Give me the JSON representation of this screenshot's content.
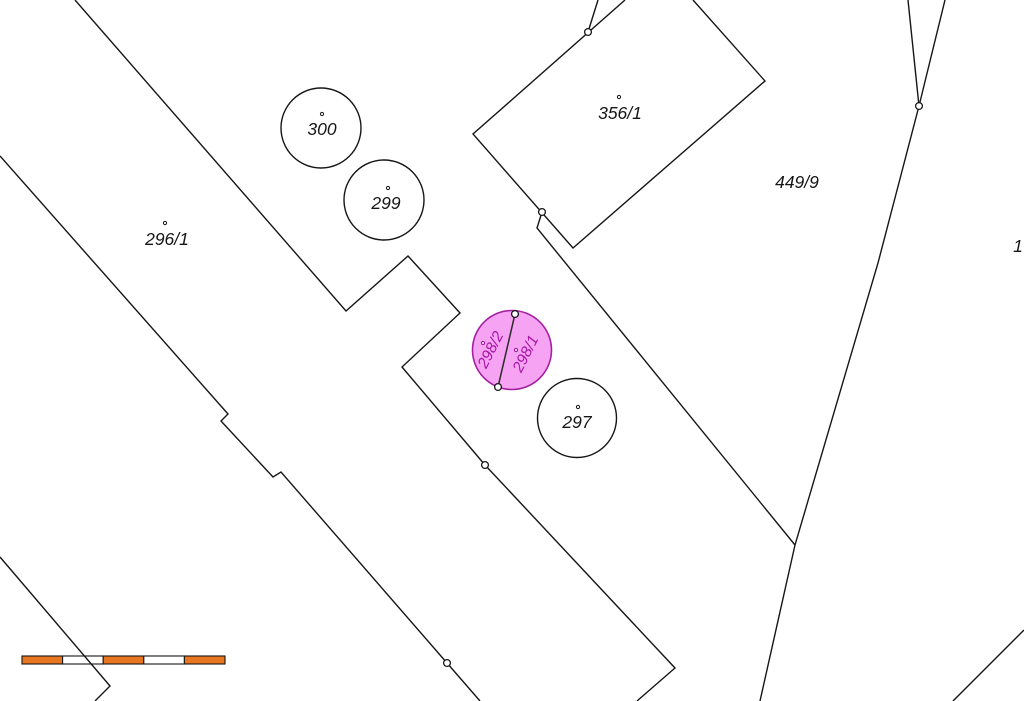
{
  "map": {
    "type": "cadastral-map",
    "colors": {
      "background": "#ffffff",
      "line": "#161616",
      "highlight_fill": "#F7A3F3",
      "highlight_stroke": "#A322A3",
      "highlight_text": "#A617A6",
      "marker_fill": "#ffffff",
      "scale_orange": "#E8751F",
      "scale_white": "#ffffff"
    }
  },
  "parcels": {
    "p296_1": {
      "label": "296/1"
    },
    "p300": {
      "label": "300"
    },
    "p299": {
      "label": "299"
    },
    "p297": {
      "label": "297"
    },
    "p356_1": {
      "label": "356/1"
    },
    "p449_9": {
      "label": "449/9"
    },
    "p1": {
      "label": "1"
    },
    "p298_2": {
      "label": "298/2"
    },
    "p298_1": {
      "label": "298/1"
    }
  },
  "highlighted_parcels": [
    "298/2",
    "298/1"
  ],
  "scale_bar": {
    "segments": 5,
    "segment_colors": [
      "#E8751F",
      "#ffffff",
      "#E8751F",
      "#ffffff",
      "#E8751F"
    ]
  }
}
